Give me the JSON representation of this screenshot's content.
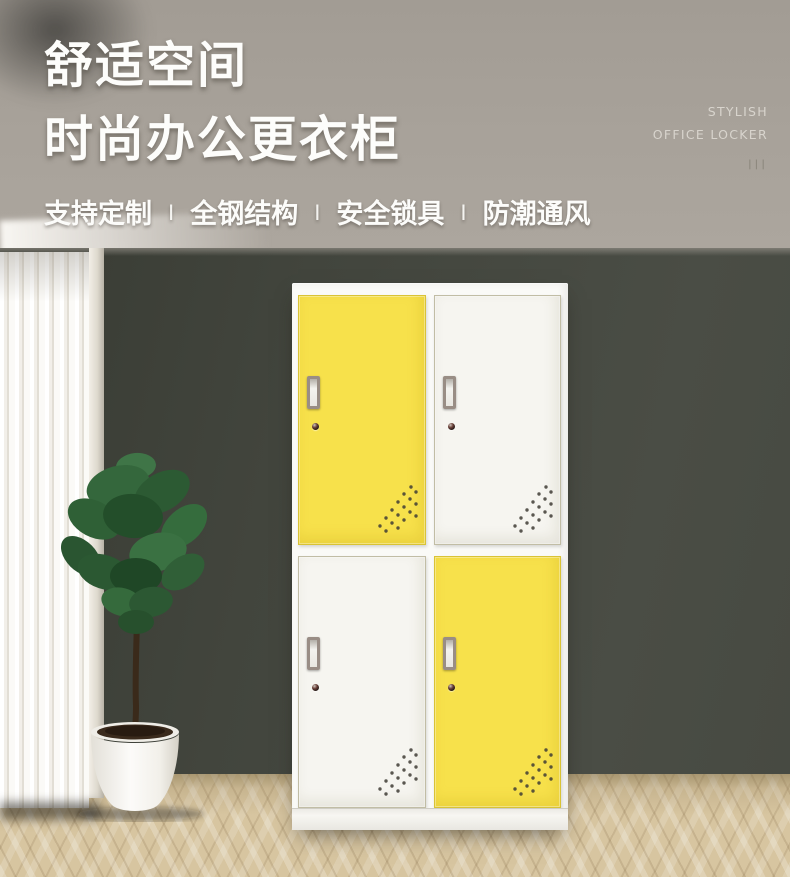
{
  "header": {
    "title_line1": "舒适空间",
    "title_line2": "时尚办公更衣柜",
    "features": [
      "支持定制",
      "全钢结构",
      "安全锁具",
      "防潮通风"
    ],
    "feature_separator": "Ⅰ",
    "tagline_en_line1": "STYLISH",
    "tagline_en_line2": "OFFICE LOCKER",
    "tagline_marks": "|||"
  },
  "scene": {
    "wall_upper_color": "#a7a199",
    "wall_lower_color": "#45483f",
    "floor_color": "#d7c5a0",
    "curtain_color": "#f7f5f1",
    "plant_type": "fiddle-leaf-fig",
    "pot_color": "#faf9f6"
  },
  "locker": {
    "frame_color": "#fafaf7",
    "accent_yellow": "#f7e14b",
    "door_white": "#f6f5f0",
    "door_colors": [
      "#f7e14b",
      "#f6f5f0",
      "#f6f5f0",
      "#f7e14b"
    ],
    "handle_color": "#998d85",
    "rows": 2,
    "columns": 2
  }
}
